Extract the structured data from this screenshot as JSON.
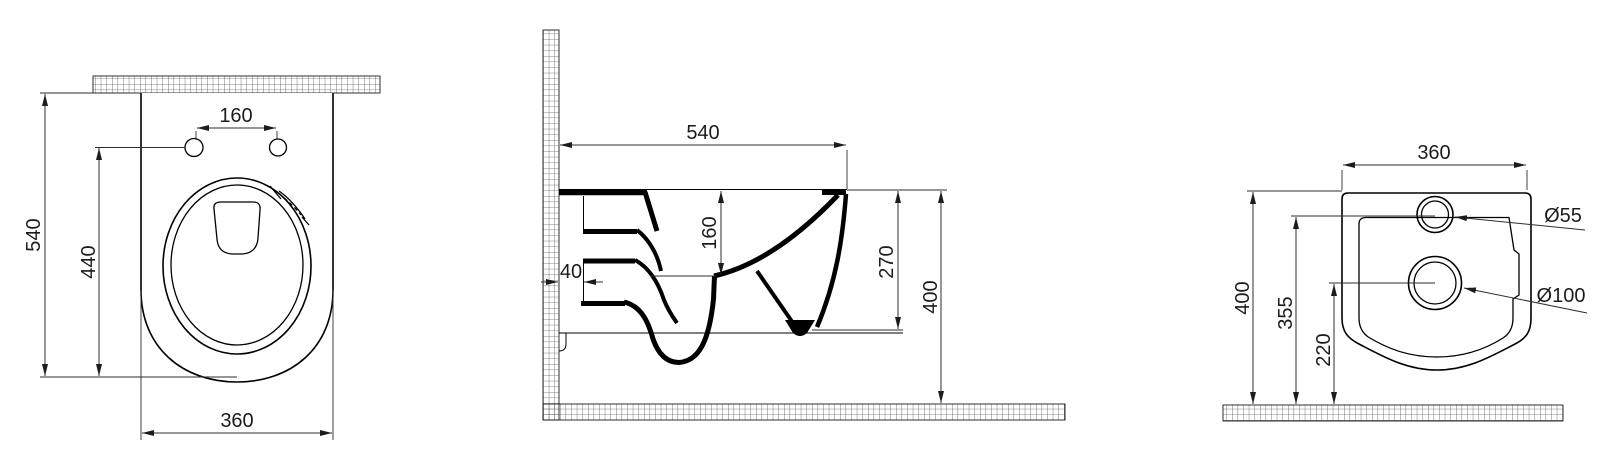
{
  "drawing": {
    "kind": "wall-hung toilet installation drawing",
    "views": {
      "top": {
        "hole_spacing": "160",
        "overall_depth": "540",
        "bowl_depth": "440",
        "width": "360"
      },
      "side": {
        "depth": "540",
        "rim_drop": "160",
        "wall_offset": "40",
        "outlet_drop": "270",
        "height": "400"
      },
      "rear": {
        "width": "360",
        "height": "400",
        "inlet_height": "355",
        "outlet_height": "220",
        "inlet_diameter": "Ø55",
        "outlet_diameter": "Ø100"
      }
    },
    "colors": {
      "line": "#000000",
      "dimension": "#2e2e2e",
      "background": "#ffffff"
    }
  }
}
